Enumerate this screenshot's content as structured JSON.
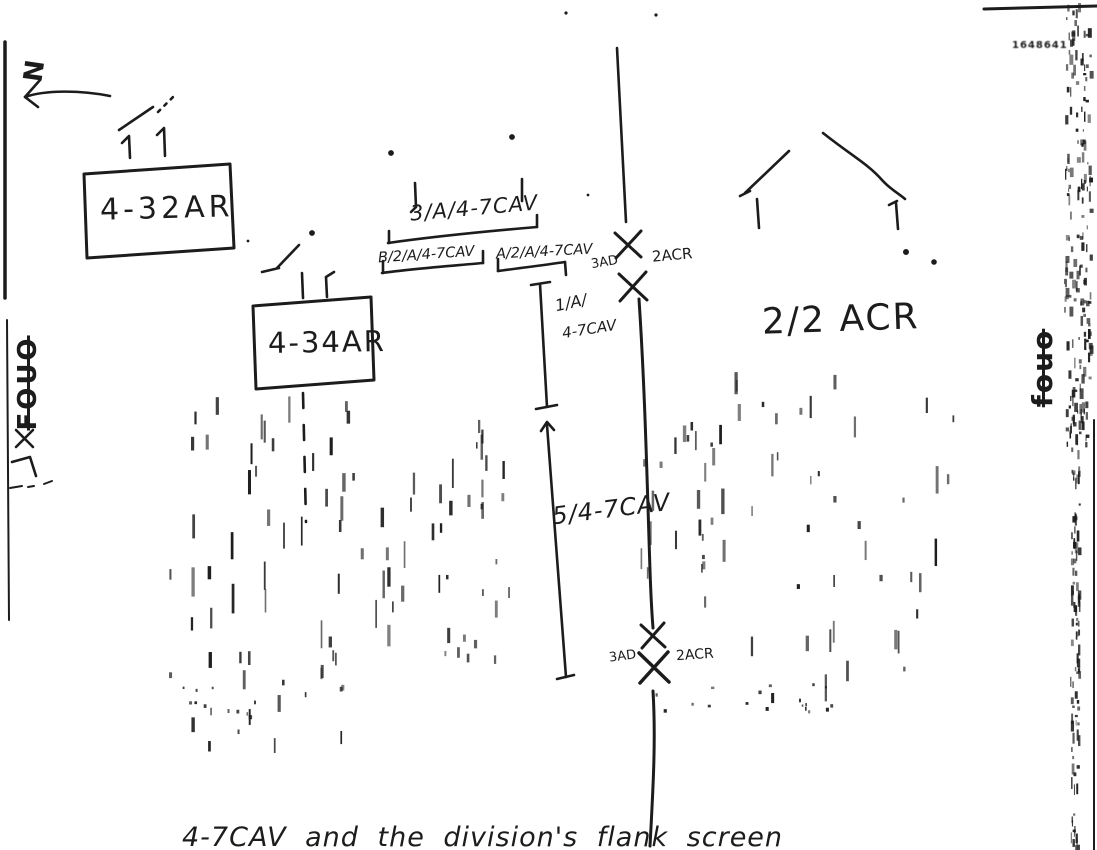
{
  "paper": "#ffffff",
  "ink": "#1c1c1c",
  "compass": {
    "label": "N"
  },
  "units": {
    "armor_battalion_1": "4-32AR",
    "armor_battalion_2": "4-34AR"
  },
  "cav_labels": {
    "platoon_3A": "3/A/4-7CAV",
    "section_B2A": "B/2/A/4-7CAV",
    "section_A2A": "A/2/A/4-7CAV",
    "platoon_1A_line1": "1/A/",
    "platoon_1A_line2": "4-7CAV",
    "troop_5": "5/4-7CAV"
  },
  "boundaries": {
    "upper": {
      "left_unit": "3AD",
      "right_unit": "2ACR"
    },
    "lower": {
      "left_unit": "3AD",
      "right_unit": "2ACR"
    }
  },
  "opfor": {
    "label": "2/2 ACR"
  },
  "stamps": {
    "left": "FOUO",
    "right": "fouo",
    "corner_mark": "1648641"
  },
  "caption": "4-7CAV and the division's flank screen"
}
